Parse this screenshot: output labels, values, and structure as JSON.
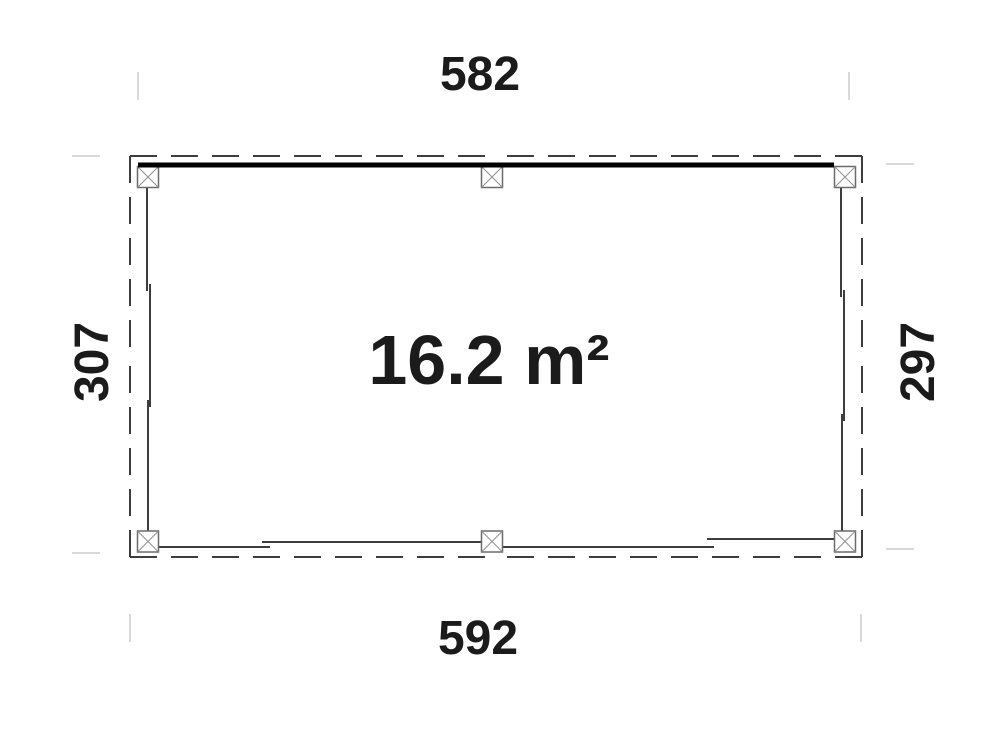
{
  "plan": {
    "area_label": "16.2 m²",
    "dim_top": "582",
    "dim_bottom": "592",
    "dim_left": "307",
    "dim_right": "297"
  },
  "icons": {
    "post_marker": "crossed-square-post-symbol"
  },
  "colors": {
    "background": "#ffffff",
    "wall_line": "#3d3d3d",
    "beam": "#000000",
    "post_fill": "#ffffff",
    "post_stroke": "#6a6a6a",
    "post_cross": "#909090",
    "guide_tick": "#d9d9d9",
    "label_text": "#1b1b1b"
  }
}
